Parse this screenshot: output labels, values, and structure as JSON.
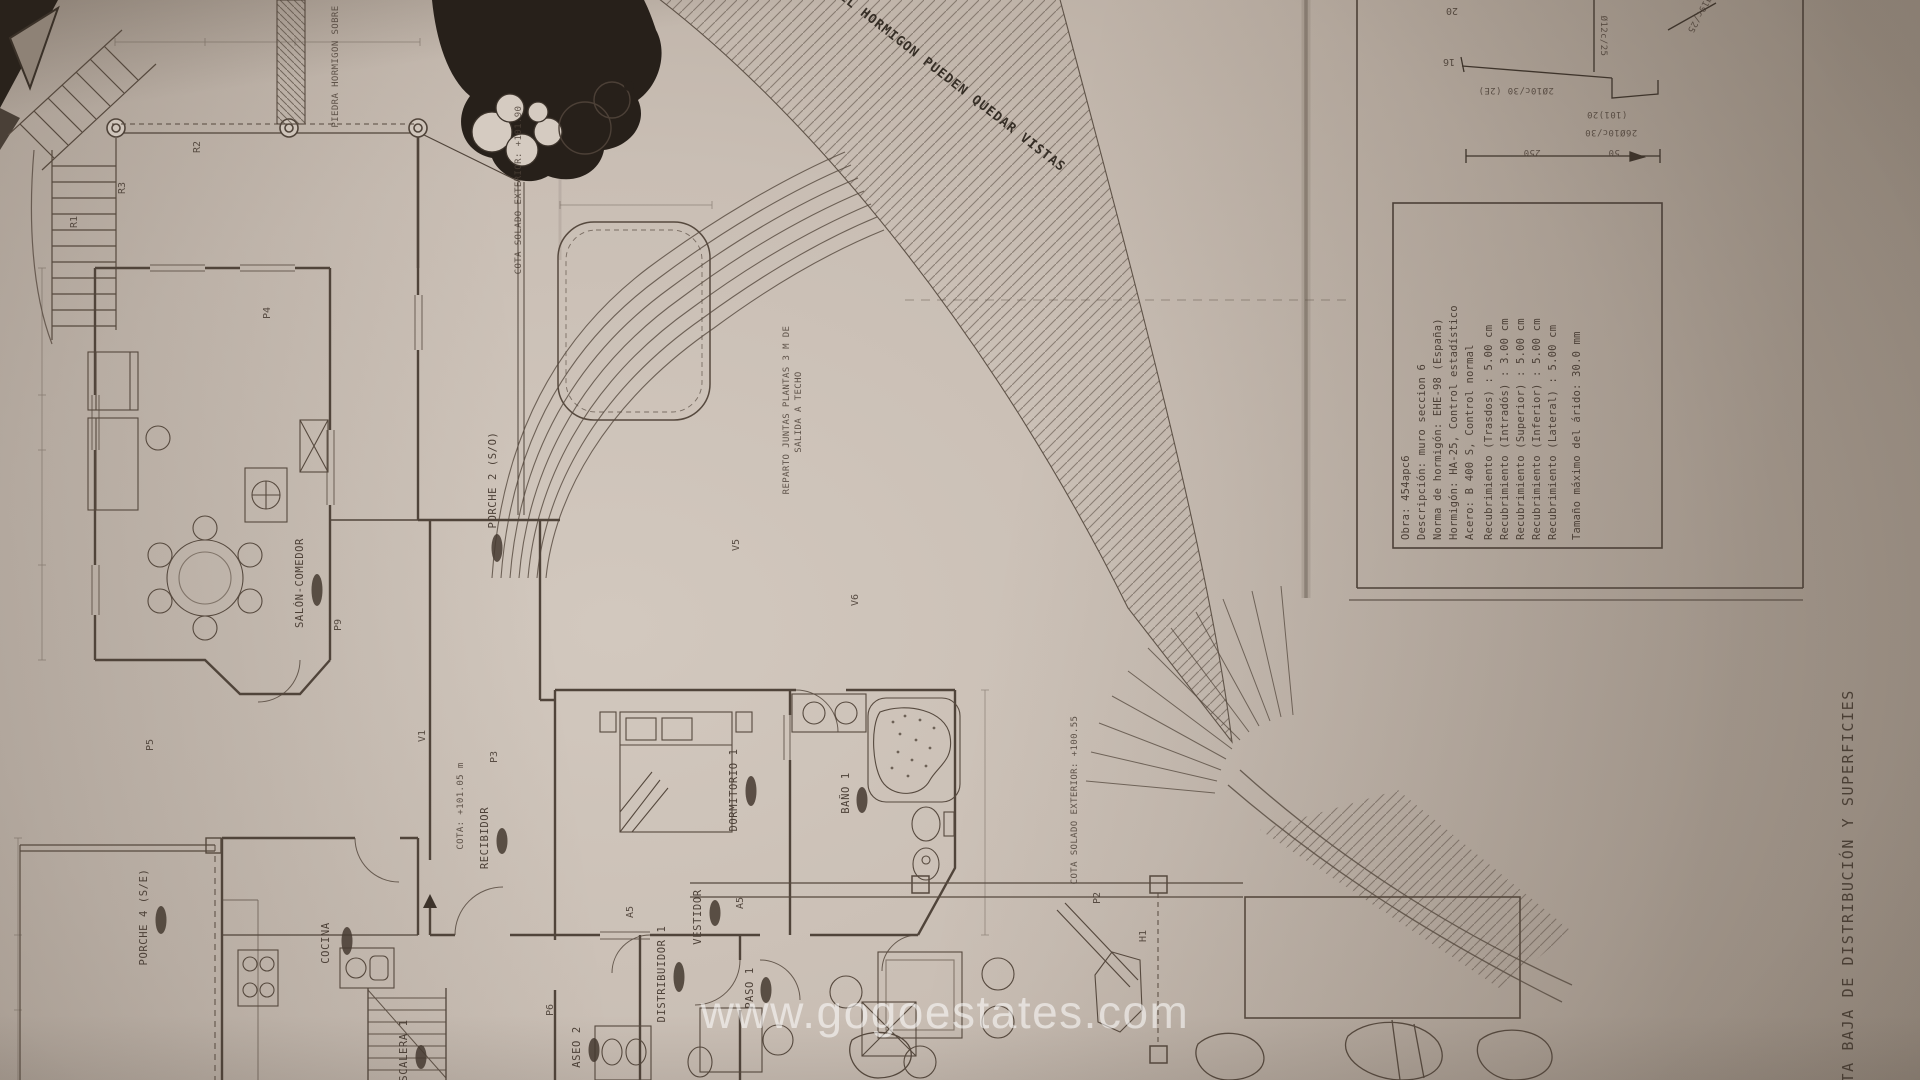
{
  "photo": {
    "paper_color": "#c9beb4",
    "ink_color": "#56493e"
  },
  "watermark": {
    "text": "www.gogoestates.com"
  },
  "sheet": {
    "title": "PLANTA BAJA DE DISTRIBUCIÓN Y SUPERFICIES",
    "spec_box": {
      "lines": [
        "Obra: 454apc6",
        "Descripción: muro seccion 6",
        "Norma de hormigón: EHE-98 (España)",
        "Hormigón: HA-25, Control estadístico",
        "Acero: B 400 S, Control normal",
        "Recubrimiento (Trasdos) : 5.00 cm",
        "Recubrimiento (Intradós) : 3.00 cm",
        "Recubrimiento (Superior) : 5.00 cm",
        "Recubrimiento (Inferior) : 5.00 cm",
        "Recubrimiento (Lateral) : 5.00 cm",
        "Tamaño máximo del árido: 30.0 mm"
      ]
    },
    "rebar_notes": [
      "2Ø10c/30 (2E)",
      "Ø12c/25",
      "(101)20",
      "26Ø10c/30",
      "Ø19c/25",
      "250",
      "50"
    ]
  },
  "plan": {
    "rooms": [
      {
        "text": "SALÓN-COMEDOR"
      },
      {
        "text": "PORCHE 2 (S/O)"
      },
      {
        "text": "PORCHE 4 (S/E)"
      },
      {
        "text": "COCINA"
      },
      {
        "text": "DORMITORIO 1"
      },
      {
        "text": "BAÑO 1"
      },
      {
        "text": "VESTIDOR"
      },
      {
        "text": "DISTRIBUIDOR 1"
      },
      {
        "text": "PASO 1"
      },
      {
        "text": "ASEO 2"
      },
      {
        "text": "ESCALERA 1"
      },
      {
        "text": "RECIBIDOR"
      }
    ],
    "cotas": [
      "COTA: +101.05 m",
      "COTA SOLADO EXTERIOR: +101.90",
      "COTA SOLADO EXTERIOR: +100.55",
      "REPARTO JUNTAS PLANTAS 3 M DE",
      "SALIDA A TECHO",
      "PIEDRA HORMIGON SOBRE MURO"
    ],
    "note_diagonal": "EL HORMIGON PUEDEN QUEDAR VISTAS",
    "markers": [
      "R1",
      "R3",
      "R2",
      "P4",
      "P5",
      "P9",
      "P3",
      "V1",
      "V5",
      "V6",
      "A5",
      "A5",
      "P2",
      "H1",
      "P6",
      "16",
      "20"
    ]
  }
}
